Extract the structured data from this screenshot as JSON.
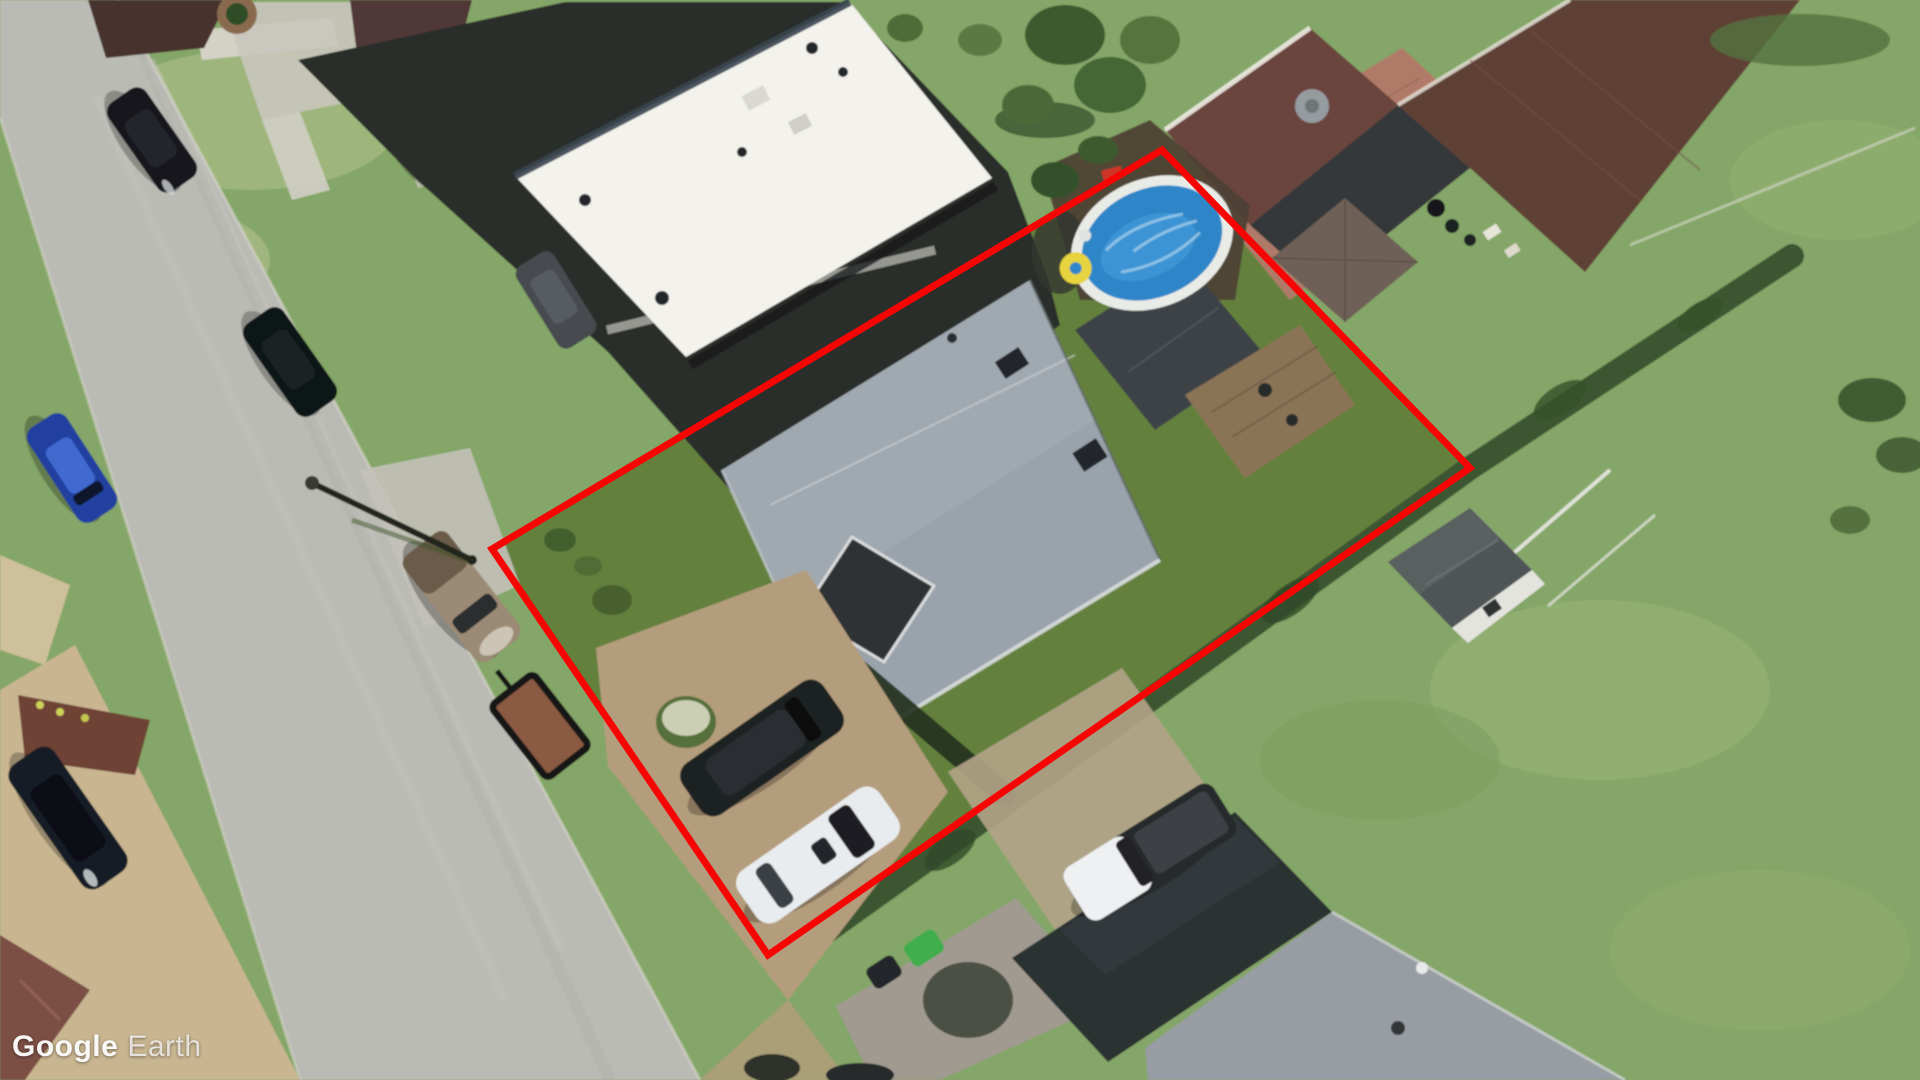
{
  "watermark": {
    "word1": "Google",
    "word2": "Earth"
  },
  "boundary": {
    "vertices": [
      [
        1162,
        150
      ],
      [
        1470,
        468
      ],
      [
        768,
        955
      ],
      [
        492,
        549
      ]
    ],
    "stroke_width": 7
  },
  "colors": {
    "boundary_red": "#f60505",
    "pool_water": "#2e86c9",
    "pool_rim": "#e9ebe7",
    "float_yellow": "#e6d33e",
    "road": "#bbbbb5",
    "asphalt_dark": "#2b2e29",
    "flat_roof_white": "#f3f2ec",
    "main_roof_gray": "#9aa3ab",
    "brown_roof": "#5e4036",
    "grass_base": "#84a667",
    "lawn_dark_green": "#5f7d3a",
    "driveway_tan": "#b49d7c",
    "bin_green": "#3fae4e"
  },
  "scene": {
    "type": "aerial-satellite-imagery",
    "objects": [
      "road",
      "property-boundary",
      "main-house",
      "flat-roof-building",
      "top-right-house",
      "bottom-right-house",
      "above-ground-pool",
      "pool-float",
      "wood-deck",
      "shed",
      "gazebo",
      "parked-cars",
      "pickup-truck",
      "utility-trailer",
      "street-light",
      "trees",
      "hedgerow",
      "driveways",
      "trash-bins",
      "lawn"
    ]
  }
}
